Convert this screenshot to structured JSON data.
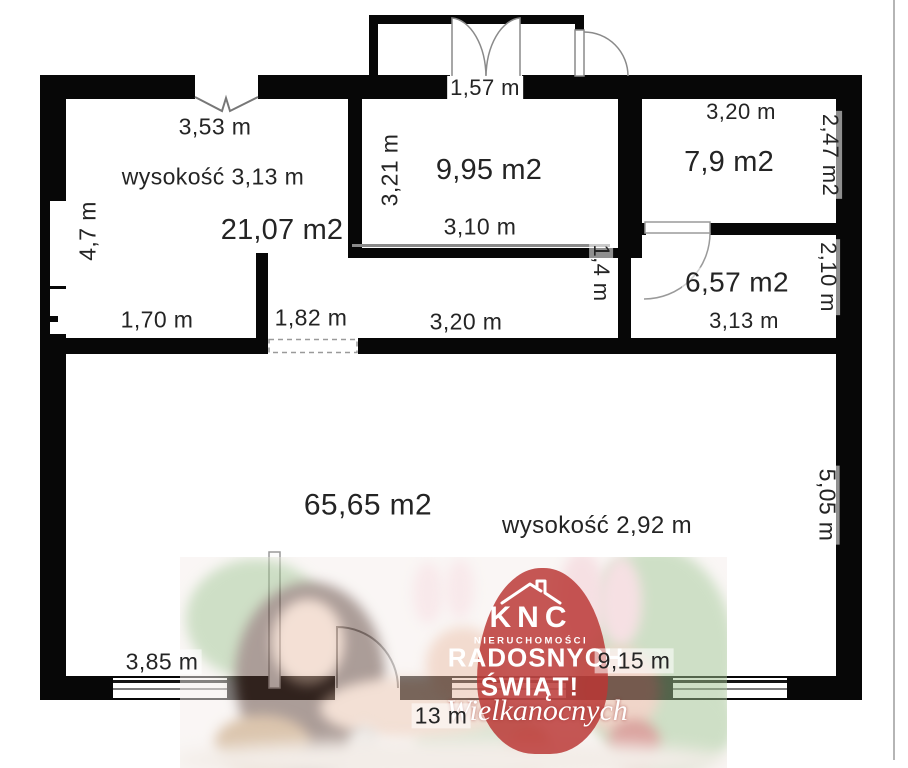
{
  "floor_plan": {
    "labels": [
      {
        "name": "room1-top-width",
        "text": "3,53 m"
      },
      {
        "name": "room1-ceiling-height",
        "text": "wysokość 3,13 m"
      },
      {
        "name": "room1-area",
        "text": "21,07 m2"
      },
      {
        "name": "room1-left-height",
        "text": "4,7 m"
      },
      {
        "name": "room1-bottom-width",
        "text": "1,70 m"
      },
      {
        "name": "opening-width",
        "text": "1,82 m"
      },
      {
        "name": "corridor-width",
        "text": "3,20 m"
      },
      {
        "name": "balcony-door-width",
        "text": "1,57 m"
      },
      {
        "name": "room2-left-height",
        "text": "3,21 m"
      },
      {
        "name": "room2-area",
        "text": "9,95 m2"
      },
      {
        "name": "room2-bottom-width",
        "text": "3,10 m"
      },
      {
        "name": "corridor-depth",
        "text": "1,4 m"
      },
      {
        "name": "room3-top-width",
        "text": "3,20 m"
      },
      {
        "name": "room3-area",
        "text": "7,9 m2"
      },
      {
        "name": "room3-right-depth",
        "text": "2,47 m2"
      },
      {
        "name": "room4-area",
        "text": "6,57 m2"
      },
      {
        "name": "room4-bottom-width",
        "text": "3,13 m"
      },
      {
        "name": "room4-right-depth",
        "text": "2,10 m"
      },
      {
        "name": "room5-area",
        "text": "65,65 m2"
      },
      {
        "name": "room5-ceiling-height",
        "text": "wysokość 2,92 m"
      },
      {
        "name": "room5-right-height",
        "text": "5,05 m"
      },
      {
        "name": "room5-window-width",
        "text": "3,85 m"
      },
      {
        "name": "room5-bottom-width",
        "text": "9,15 m"
      },
      {
        "name": "total-bottom-width",
        "text": "13 m"
      }
    ]
  },
  "watermark": {
    "logo_icon": "house-outline-icon",
    "brand": "KNC",
    "brand_subtitle": "NIERUCHOMOŚCI",
    "greeting_line1": "RADOSNYCH",
    "greeting_line2": "ŚWIĄT!",
    "greeting_line3": "Wielkanocnych",
    "egg_color": "#b93733",
    "text_color": "#ffffff"
  }
}
